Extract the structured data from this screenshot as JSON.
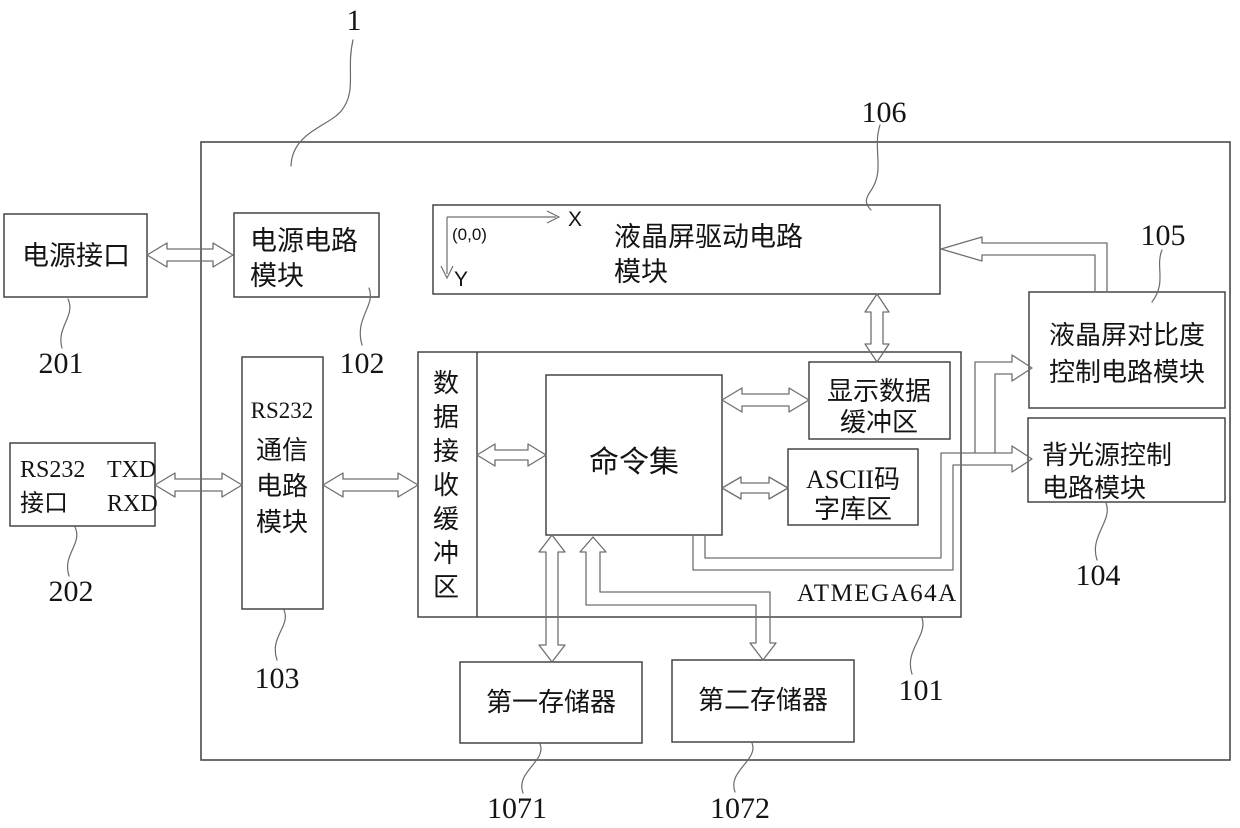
{
  "figure": {
    "ref_labels": {
      "system": "1",
      "lcd_driver": "106",
      "contrast": "105",
      "power_interface": "201",
      "power_circuit": "102",
      "rs232_interface": "202",
      "rs232_comm": "103",
      "mcu": "101",
      "backlight": "104",
      "memory1": "1071",
      "memory2": "1072"
    },
    "boxes": {
      "power_interface": {
        "label": "电源接口"
      },
      "power_circuit": {
        "line1": "电源电路",
        "line2": "模块"
      },
      "rs232_interface": {
        "line1_left": "RS232",
        "line1_right": "TXD",
        "line2_left": "接口",
        "line2_right": "RXD"
      },
      "rs232_comm": {
        "line1": "RS232",
        "line2": "通信",
        "line3": "电路",
        "line4": "模块"
      },
      "lcd_driver": {
        "line1": "液晶屏驱动电路",
        "line2": "模块",
        "origin_label": "(0,0)",
        "x_axis_label": "X",
        "y_axis_label": "Y"
      },
      "mcu": {
        "chip_label": "ATMEGA64A"
      },
      "data_rx_buffer": {
        "label": "数据接收缓冲区"
      },
      "command_set": {
        "label": "命令集"
      },
      "display_buffer": {
        "line1": "显示数据",
        "line2": "缓冲区"
      },
      "ascii_font": {
        "line1": "ASCII码",
        "line2": "字库区"
      },
      "contrast": {
        "line1": "液晶屏对比度",
        "line2": "控制电路模块"
      },
      "backlight": {
        "line1": "背光源控制",
        "line2": "电路模块"
      },
      "memory1": {
        "label": "第一存储器"
      },
      "memory2": {
        "label": "第二存储器"
      }
    },
    "colors": {
      "ink": "#141414",
      "box_stroke": "#454545",
      "arrow_stroke": "#6f6f6f",
      "background": "#ffffff"
    }
  }
}
